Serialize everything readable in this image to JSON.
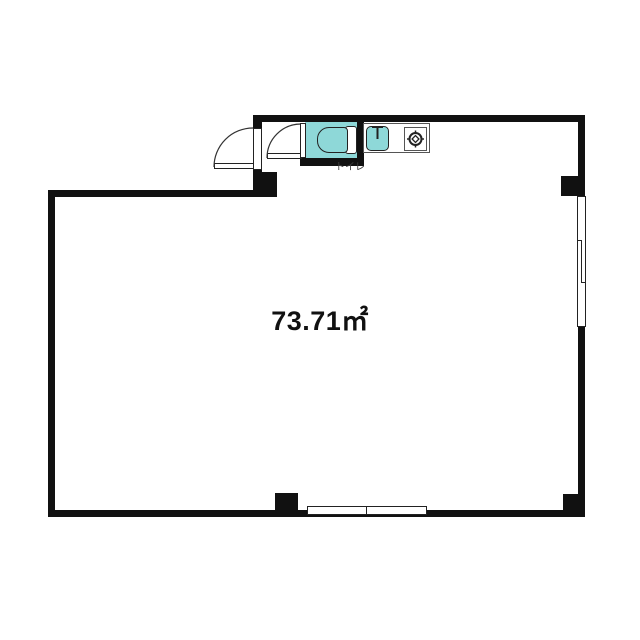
{
  "floorplan": {
    "area_label": "73.71㎡",
    "toilet_label": "トイレ",
    "colors": {
      "wall": "#111111",
      "fixture": "#8ed8d8",
      "outline": "#333333",
      "text": "#111111",
      "label": "#3d3d3d",
      "bg": "#ffffff",
      "thin": "#222222"
    },
    "icons": [
      "entry-door-swing-icon",
      "toilet-door-swing-icon",
      "toilet-icon",
      "sink-icon",
      "faucet-icon",
      "gas-burner-icon",
      "sliding-window-icon"
    ],
    "rooms": [
      {
        "name": "main-room",
        "label": "73.71㎡"
      },
      {
        "name": "toilet-room",
        "label": "トイレ"
      }
    ]
  }
}
